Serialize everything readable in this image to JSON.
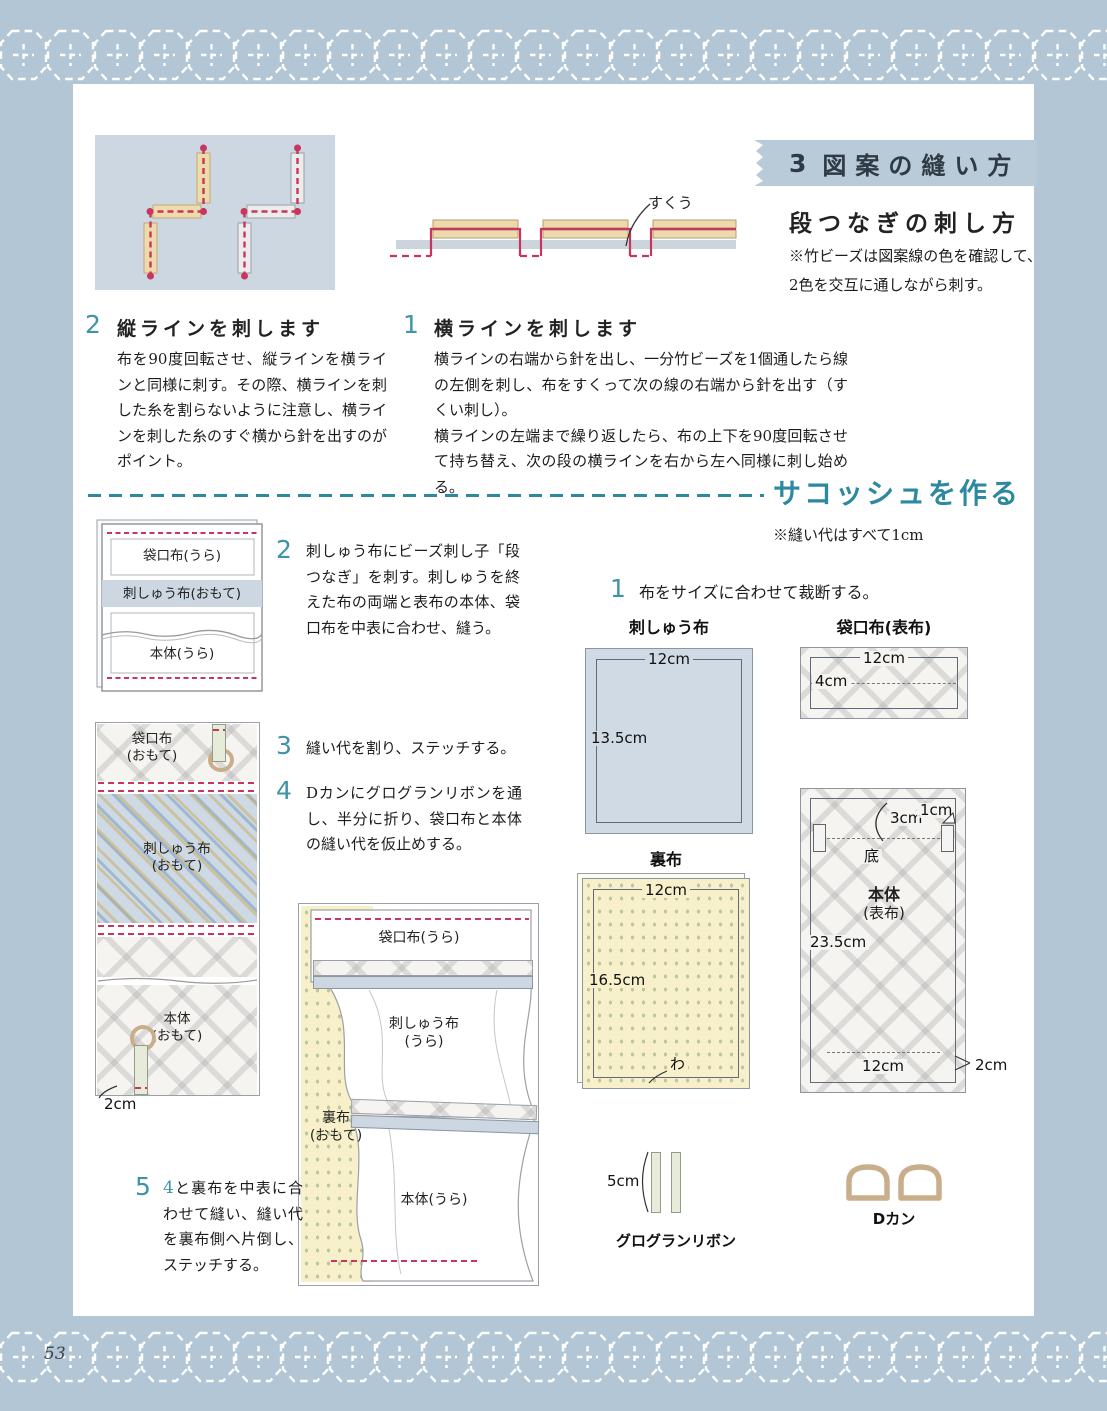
{
  "page": {
    "number": "53"
  },
  "colors": {
    "teal": "#2e88a0",
    "stitch_red": "#c8355e",
    "panel_blue": "#ccd7e1",
    "band_blue": "#b9cbd8",
    "bead_tan": "#eedbab",
    "fabric_yellow": "#f7f0ca",
    "ring_tan": "#c9ae8c"
  },
  "header": {
    "number": "3",
    "title": "図案の縫い方",
    "subtitle": "段つなぎの刺し方",
    "note": "※竹ビーズは図案線の色を確認して、\n2色を交互に通しながら刺す。"
  },
  "stitch_steps": {
    "sukuu_label": "すくう",
    "yoko": {
      "num": "1",
      "title": "横ラインを刺します",
      "body": "横ラインの右端から針を出し、一分竹ビーズを1個通したら線の左側を刺し、布をすくって次の線の右端から針を出す（すくい刺し）。\n横ラインの左端まで繰り返したら、布の上下を90度回転させて持ち替え、次の段の横ラインを右から左へ同様に刺し始める。"
    },
    "tate": {
      "num": "2",
      "title": "縦ラインを刺します",
      "body": "布を90度回転させ、縦ラインを横ラインと同様に刺す。その際、横ラインを刺した糸を割らないように注意し、横ラインを刺した糸のすぐ横から針を出すのがポイント。"
    }
  },
  "sacoche": {
    "heading": "サコッシュを作る",
    "seam_note": "※縫い代はすべて1cm",
    "step1": {
      "num": "1",
      "text": "布をサイズに合わせて裁断する。"
    },
    "step2": {
      "num": "2",
      "text": "刺しゅう布にビーズ刺し子「段つなぎ」を刺す。刺しゅうを終えた布の両端と表布の本体、袋口布を中表に合わせ、縫う。"
    },
    "step3": {
      "num": "3",
      "text": "縫い代を割り、ステッチする。"
    },
    "step4": {
      "num": "4",
      "text": "Dカンにグログランリボンを通し、半分に折り、袋口布と本体の縫い代を仮止めする。"
    },
    "step5": {
      "num": "5",
      "ref": "4",
      "text": "と裏布を中表に合わせて縫い、縫い代を裏布側へ片倒し、ステッチする。"
    }
  },
  "diagrams": {
    "stack1": {
      "top": "袋口布(うら)",
      "mid": "刺しゅう布(おもて)",
      "bottom": "本体(うら)"
    },
    "stack2": {
      "top": "袋口布\n(おもて)",
      "mid": "刺しゅう布\n(おもて)",
      "bottom": "本体\n(おもて)",
      "dim": "2cm"
    },
    "stack3": {
      "top": "袋口布(うら)",
      "mid": "刺しゅう布\n(うら)",
      "left": "裏布\n(おもて)",
      "bottom": "本体(うら)"
    },
    "embroidery": {
      "title": "刺しゅう布",
      "width": "12cm",
      "height": "13.5cm"
    },
    "pocket": {
      "title": "袋口布(表布)",
      "width": "12cm",
      "height": "4cm"
    },
    "lining": {
      "title": "裏布",
      "width": "12cm",
      "height": "16.5cm",
      "fold": "わ"
    },
    "body": {
      "title1": "本体",
      "title2": "(表布)",
      "top_fold": "3cm",
      "corner": "1cm",
      "bottom_mark": "底",
      "height": "23.5cm",
      "width": "12cm",
      "side": "2cm"
    },
    "ribbon": {
      "label": "グログランリボン",
      "length": "5cm"
    },
    "dring": {
      "label": "Dカン"
    }
  }
}
